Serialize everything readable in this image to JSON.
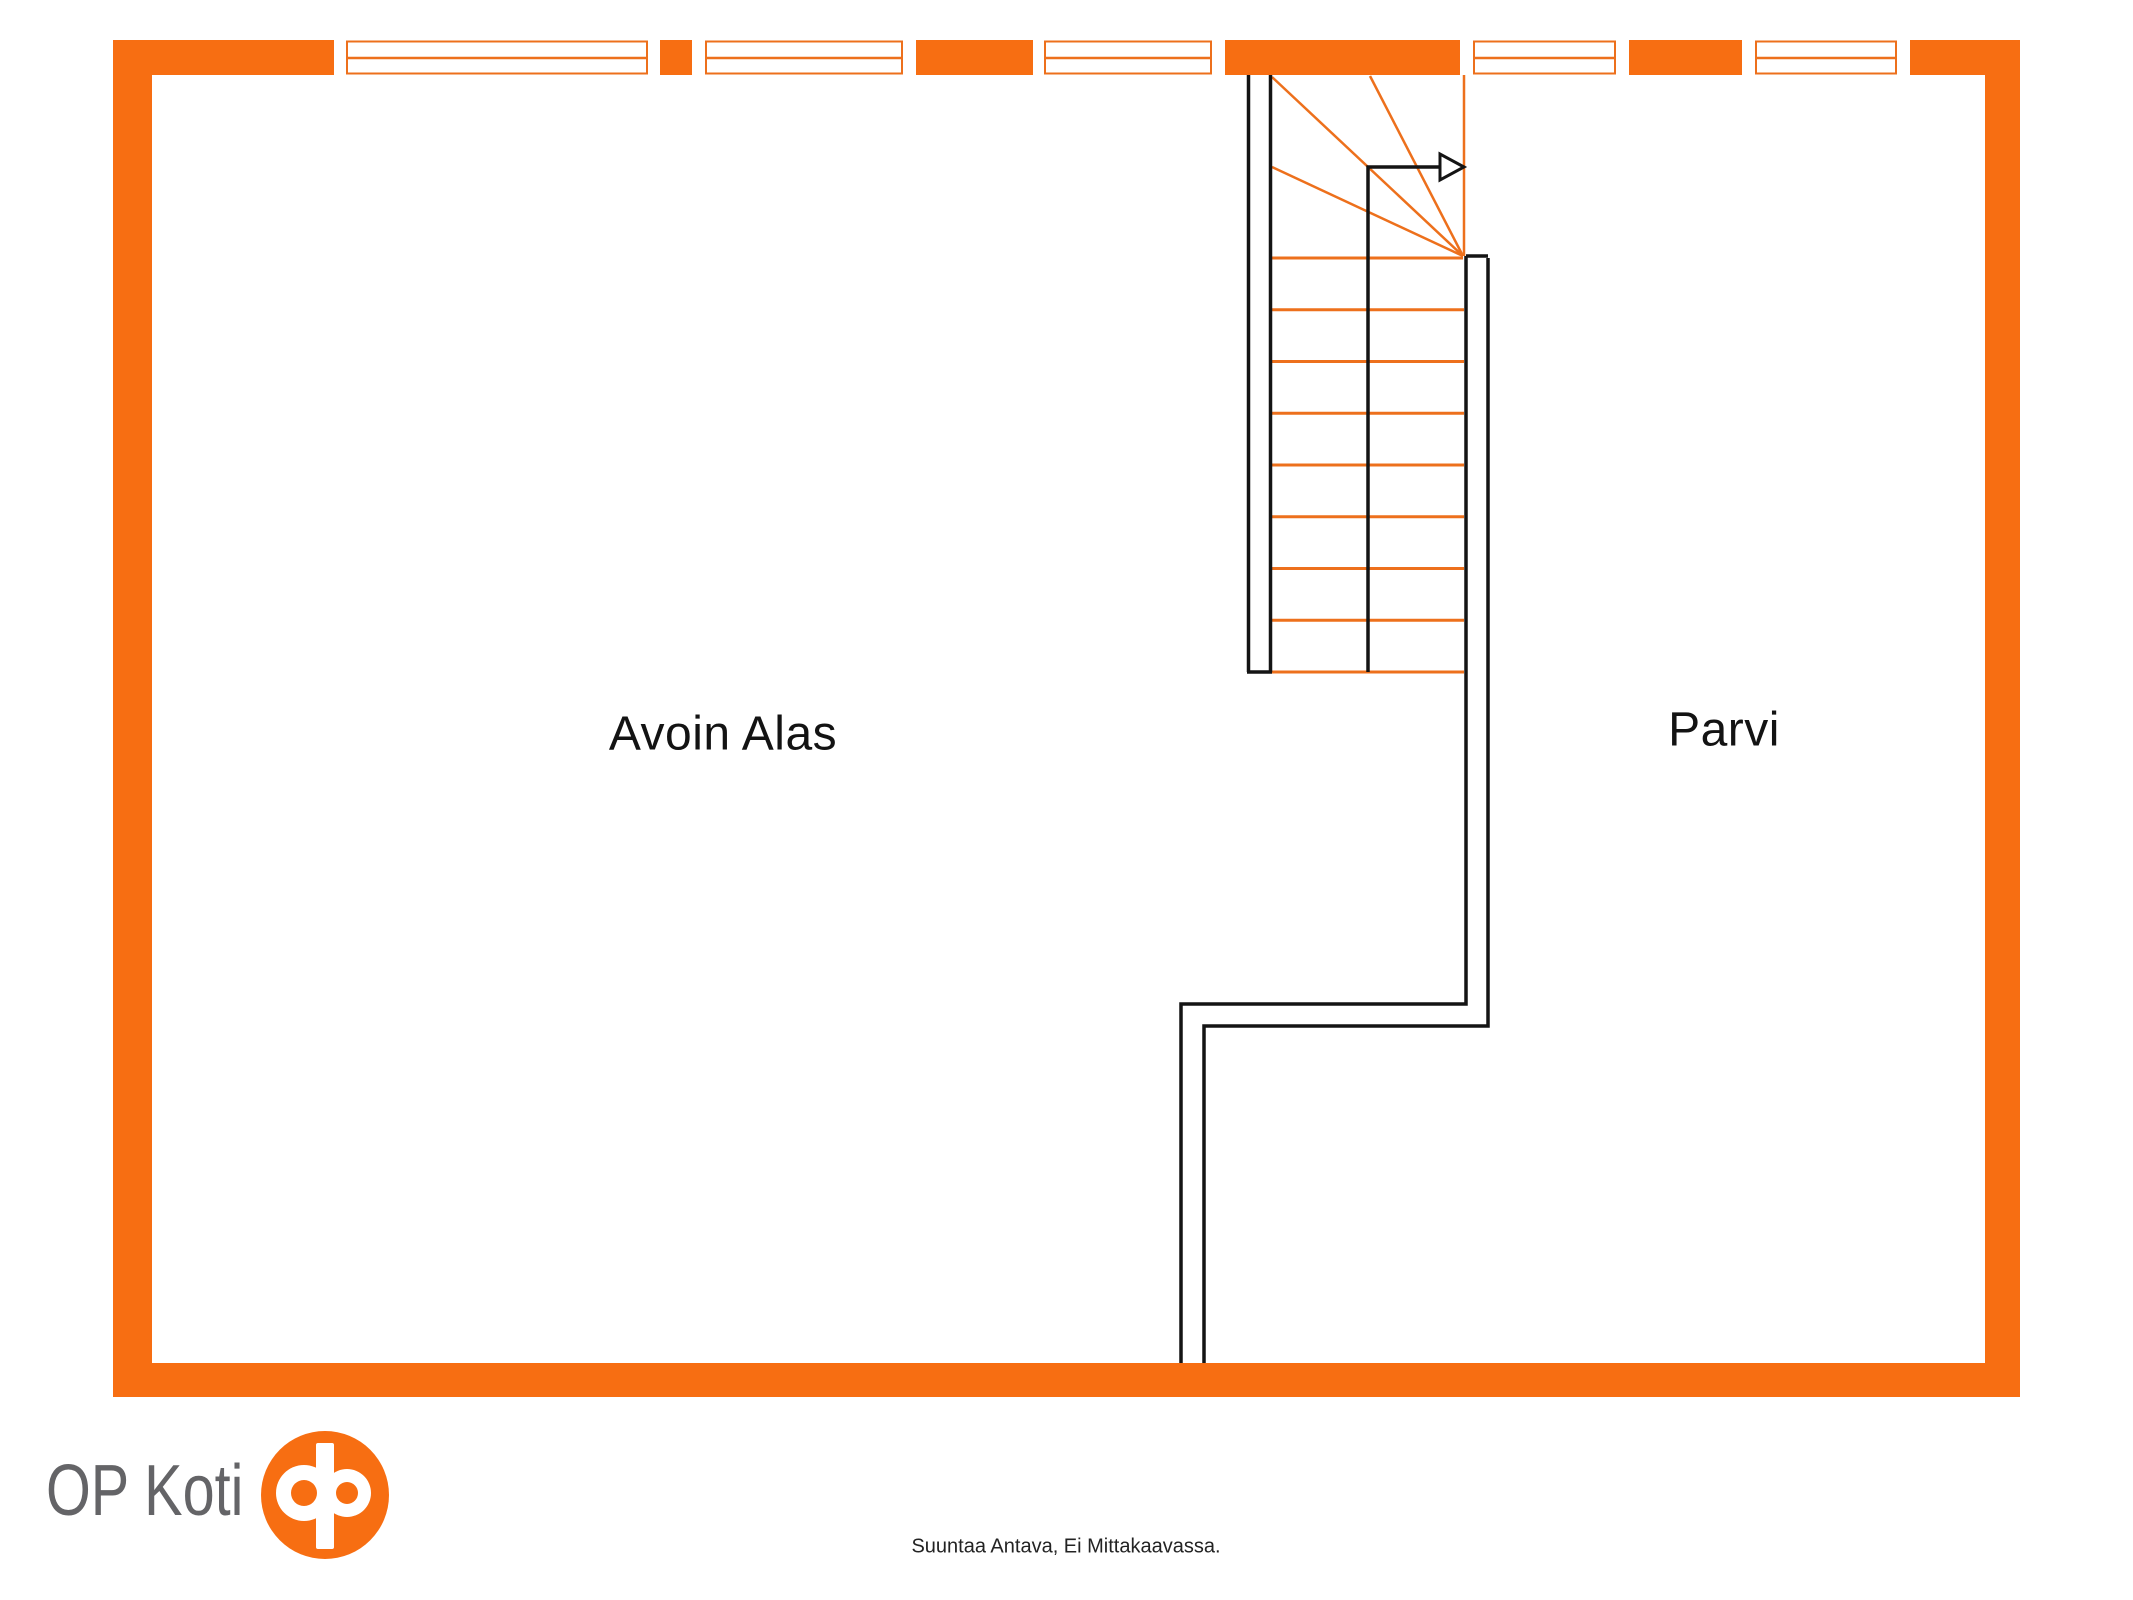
{
  "plan": {
    "type": "floor-plan",
    "floor_description": "upper floor / loft level",
    "rooms": [
      {
        "id": "avoin-alas",
        "label": "Avoin Alas"
      },
      {
        "id": "parvi",
        "label": "Parvi"
      }
    ],
    "windows_on_top_wall": 5,
    "staircase": {
      "straight_treads": 9,
      "winder_fan_lines": 3,
      "direction_arrow": "right"
    }
  },
  "footer": {
    "brand": "OP Koti",
    "caption": "Suuntaa Antava, Ei Mittakaavassa."
  },
  "colors": {
    "wall": "#F76E12",
    "line": "#ED701C",
    "black": "#141414",
    "brand_text": "#646467",
    "background": "#FFFFFF"
  }
}
